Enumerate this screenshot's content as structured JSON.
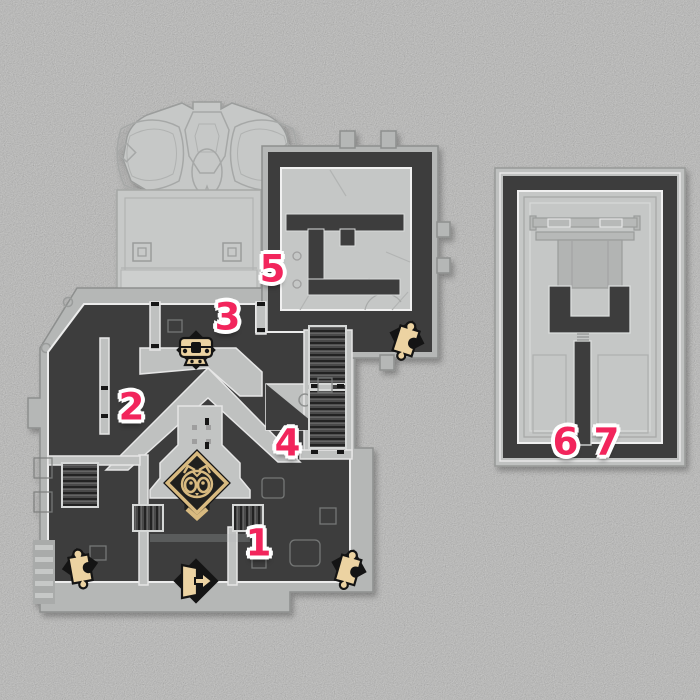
{
  "canvas": {
    "width": 700,
    "height": 700
  },
  "colors": {
    "background": "#d8d8d7",
    "map_casing": "#b5b7b6",
    "map_panel": "#c6c8c7",
    "dark_room": "#3d3e3e",
    "outline_light": "#ececec",
    "outline_dark": "#8d8f8e",
    "marker_pink": "#f2255c",
    "marker_halo": "#ffffff",
    "icon_tan": "#ecd3a2",
    "icon_black": "#141414",
    "tanuki_gold": "#d8ba80"
  },
  "markers": [
    {
      "label": "1",
      "x": 258,
      "y": 543
    },
    {
      "label": "2",
      "x": 131,
      "y": 407
    },
    {
      "label": "3",
      "x": 227,
      "y": 317
    },
    {
      "label": "4",
      "x": 287,
      "y": 443
    },
    {
      "label": "5",
      "x": 272,
      "y": 269
    },
    {
      "label": "6",
      "x": 565,
      "y": 442
    },
    {
      "label": "7",
      "x": 606,
      "y": 442
    }
  ],
  "icons": [
    {
      "name": "treasure-chest",
      "x": 196,
      "y": 350,
      "rotation": 0
    },
    {
      "name": "tanuki",
      "x": 197,
      "y": 492,
      "rotation": 0
    },
    {
      "name": "exit-door",
      "x": 196,
      "y": 581,
      "rotation": 0
    },
    {
      "name": "puzzle-piece",
      "x": 80,
      "y": 566,
      "rotation": -10
    },
    {
      "name": "puzzle-piece",
      "x": 349,
      "y": 567,
      "rotation": 16
    },
    {
      "name": "puzzle-piece",
      "x": 407,
      "y": 338,
      "rotation": 18
    }
  ]
}
